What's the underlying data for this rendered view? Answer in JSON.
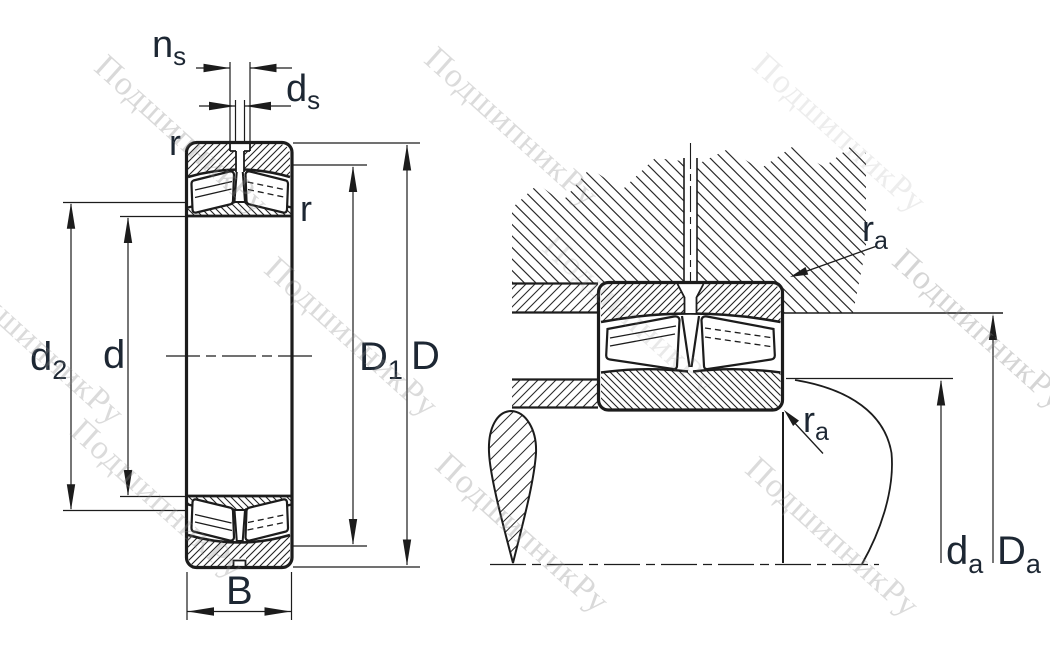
{
  "watermark": {
    "text": "ПодшипникРу"
  },
  "labels": {
    "ns": {
      "main": "n",
      "sub": "s"
    },
    "ds": {
      "main": "d",
      "sub": "s"
    },
    "r_top_left": {
      "main": "r"
    },
    "r_right": {
      "main": "r"
    },
    "d2": {
      "main": "d",
      "sub": "2"
    },
    "d": {
      "main": "d"
    },
    "D1": {
      "main": "D",
      "sub": "1"
    },
    "D": {
      "main": "D"
    },
    "B": {
      "main": "B"
    },
    "ra_top": {
      "main": "r",
      "sub": "a"
    },
    "ra_bottom": {
      "main": "r",
      "sub": "a"
    },
    "da": {
      "main": "d",
      "sub": "a"
    },
    "Da": {
      "main": "D",
      "sub": "a"
    }
  },
  "colors": {
    "line": "#1c1c1c",
    "label_text": "#1d2733",
    "watermark": "#8a8a8a",
    "background": "#ffffff"
  }
}
